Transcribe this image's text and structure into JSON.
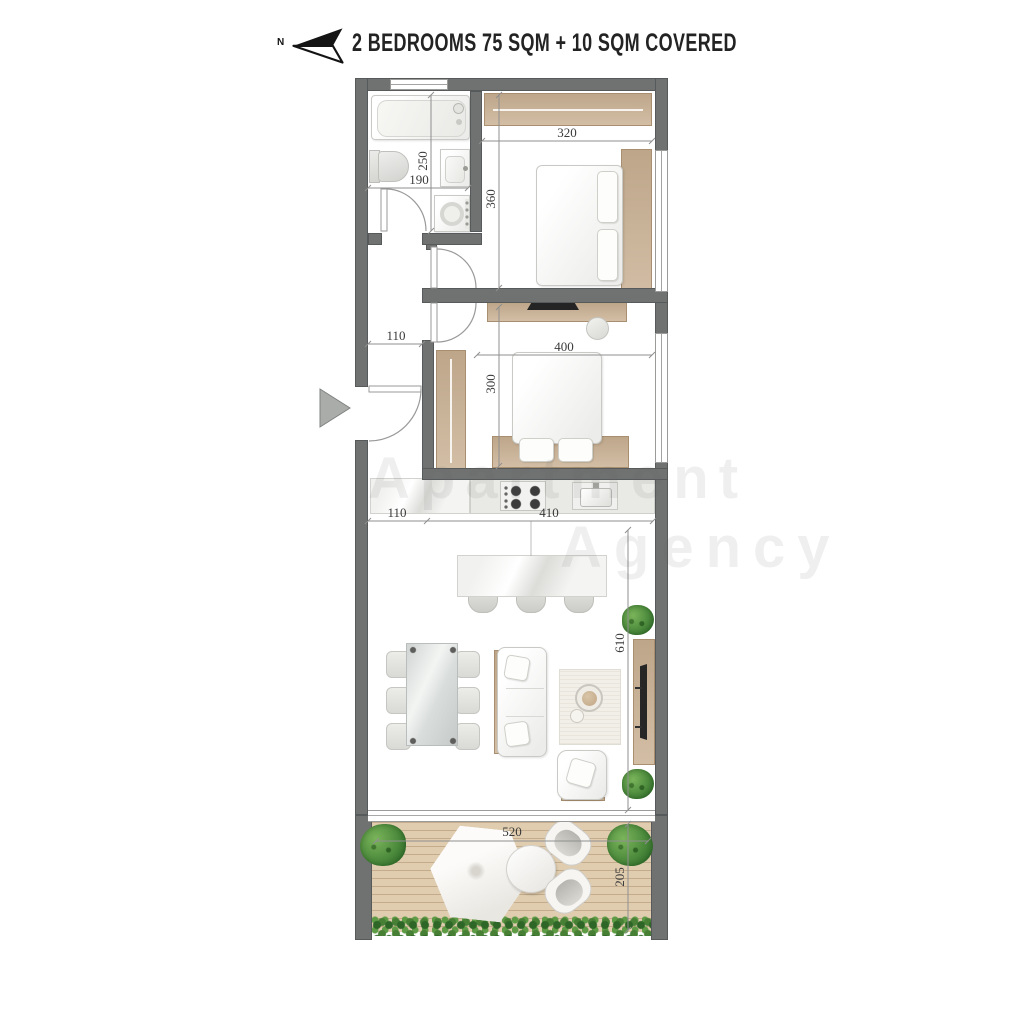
{
  "header": {
    "north_label": "N",
    "title": "2 BEDROOMS 75 SQM + 10 SQM COVERED"
  },
  "dimensions": {
    "bathroom": {
      "width": "190",
      "height": "250"
    },
    "bedroom1": {
      "width": "320",
      "height": "360"
    },
    "bedroom2": {
      "width": "400",
      "height": "300"
    },
    "hall": {
      "width": "110"
    },
    "kitchen": {
      "offset": "110",
      "width": "410"
    },
    "living": {
      "height": "610"
    },
    "balcony": {
      "width": "520",
      "height": "205"
    }
  },
  "watermark": {
    "line1": "Apartment",
    "line2": "Agency"
  },
  "colors": {
    "wall": "#6f7271",
    "wood": "#c9b092",
    "deck": "#e0cdaf",
    "plant_green": "#4c8a3c",
    "title_text": "#232323",
    "dimension_text": "#3a3a3a"
  }
}
